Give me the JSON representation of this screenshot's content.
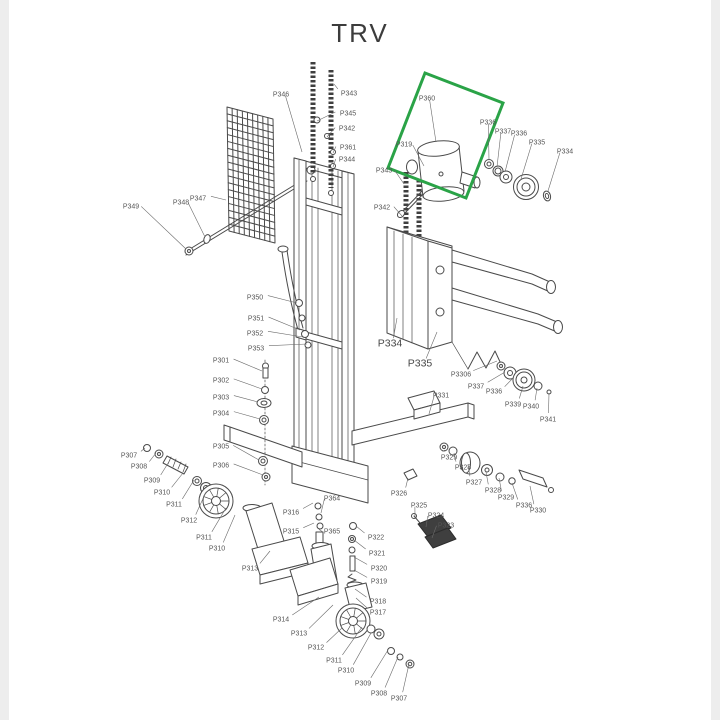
{
  "title": "TRV",
  "colors": {
    "line": "#4a4a4a",
    "label": "#555555",
    "highlight": "#2aa347",
    "background": "#ffffff"
  },
  "highlight_box": {
    "shape": "rotated-rectangle",
    "highlighted_part": "P360"
  },
  "labels": [
    {
      "t": "P343",
      "x": 349,
      "y": 93,
      "tx": 334,
      "ty": 84
    },
    {
      "t": "P345",
      "x": 348,
      "y": 113,
      "tx": 317,
      "ty": 121
    },
    {
      "t": "P342",
      "x": 347,
      "y": 128,
      "tx": 327,
      "ty": 137
    },
    {
      "t": "P361",
      "x": 348,
      "y": 147,
      "tx": 333,
      "ty": 153
    },
    {
      "t": "P344",
      "x": 347,
      "y": 159,
      "tx": 333,
      "ty": 167
    },
    {
      "t": "P346",
      "x": 281,
      "y": 94,
      "tx": 302,
      "ty": 152
    },
    {
      "t": "P347",
      "x": 198,
      "y": 198,
      "tx": 226,
      "ty": 200
    },
    {
      "t": "P348",
      "x": 181,
      "y": 202,
      "tx": 205,
      "ty": 237
    },
    {
      "t": "P349",
      "x": 131,
      "y": 206,
      "tx": 186,
      "ty": 249
    },
    {
      "t": "P343",
      "x": 384,
      "y": 170,
      "tx": 404,
      "ty": 184
    },
    {
      "t": "P342",
      "x": 382,
      "y": 207,
      "tx": 402,
      "ty": 216
    },
    {
      "t": "P360",
      "x": 427,
      "y": 98,
      "tx": 436,
      "ty": 142
    },
    {
      "t": "P319",
      "x": 404,
      "y": 144,
      "tx": 424,
      "ty": 166
    },
    {
      "t": "P336",
      "x": 488,
      "y": 122,
      "tx": 489,
      "ty": 160
    },
    {
      "t": "P337",
      "x": 503,
      "y": 131,
      "tx": 497,
      "ty": 167
    },
    {
      "t": "P336",
      "x": 519,
      "y": 133,
      "tx": 505,
      "ty": 172
    },
    {
      "t": "P335",
      "x": 537,
      "y": 142,
      "tx": 521,
      "ty": 179
    },
    {
      "t": "P334",
      "x": 565,
      "y": 151,
      "tx": 548,
      "ty": 191
    },
    {
      "t": "P334",
      "x": 390,
      "y": 344,
      "tx": 397,
      "ty": 318,
      "big": true
    },
    {
      "t": "P335",
      "x": 420,
      "y": 364,
      "tx": 437,
      "ty": 332,
      "big": true
    },
    {
      "t": "P3306",
      "x": 461,
      "y": 374,
      "tx": 497,
      "ty": 361
    },
    {
      "t": "P337",
      "x": 476,
      "y": 386,
      "tx": 505,
      "ty": 372
    },
    {
      "t": "P336",
      "x": 494,
      "y": 391,
      "tx": 514,
      "ty": 377
    },
    {
      "t": "P339",
      "x": 513,
      "y": 404,
      "tx": 523,
      "ty": 386
    },
    {
      "t": "P340",
      "x": 531,
      "y": 406,
      "tx": 537,
      "ty": 388
    },
    {
      "t": "P341",
      "x": 548,
      "y": 419,
      "tx": 549,
      "ty": 393
    },
    {
      "t": "P331",
      "x": 441,
      "y": 395,
      "tx": 429,
      "ty": 414
    },
    {
      "t": "P301",
      "x": 221,
      "y": 360,
      "tx": 262,
      "ty": 371
    },
    {
      "t": "P302",
      "x": 221,
      "y": 380,
      "tx": 262,
      "ty": 389
    },
    {
      "t": "P303",
      "x": 221,
      "y": 397,
      "tx": 258,
      "ty": 402
    },
    {
      "t": "P304",
      "x": 221,
      "y": 413,
      "tx": 260,
      "ty": 419
    },
    {
      "t": "P305",
      "x": 221,
      "y": 446,
      "tx": 259,
      "ty": 460
    },
    {
      "t": "P306",
      "x": 221,
      "y": 465,
      "tx": 263,
      "ty": 475
    },
    {
      "t": "P350",
      "x": 255,
      "y": 297,
      "tx": 297,
      "ty": 303
    },
    {
      "t": "P351",
      "x": 256,
      "y": 318,
      "tx": 300,
      "ty": 330
    },
    {
      "t": "P352",
      "x": 255,
      "y": 333,
      "tx": 303,
      "ty": 337
    },
    {
      "t": "P353",
      "x": 256,
      "y": 348,
      "tx": 307,
      "ty": 344
    },
    {
      "t": "P307",
      "x": 129,
      "y": 455,
      "tx": 145,
      "ty": 448
    },
    {
      "t": "P308",
      "x": 139,
      "y": 466,
      "tx": 156,
      "ty": 453
    },
    {
      "t": "P309",
      "x": 152,
      "y": 480,
      "tx": 170,
      "ty": 460
    },
    {
      "t": "P310",
      "x": 162,
      "y": 492,
      "tx": 183,
      "ty": 473
    },
    {
      "t": "P311",
      "x": 174,
      "y": 504,
      "tx": 194,
      "ty": 480
    },
    {
      "t": "P312",
      "x": 189,
      "y": 520,
      "tx": 206,
      "ty": 492
    },
    {
      "t": "P311",
      "x": 204,
      "y": 537,
      "tx": 226,
      "ty": 508
    },
    {
      "t": "P310",
      "x": 217,
      "y": 548,
      "tx": 235,
      "ty": 515
    },
    {
      "t": "P313",
      "x": 250,
      "y": 568,
      "tx": 270,
      "ty": 551
    },
    {
      "t": "P314",
      "x": 281,
      "y": 619,
      "tx": 319,
      "ty": 597
    },
    {
      "t": "P313",
      "x": 299,
      "y": 633,
      "tx": 333,
      "ty": 605
    },
    {
      "t": "P312",
      "x": 316,
      "y": 647,
      "tx": 342,
      "ty": 628
    },
    {
      "t": "P311",
      "x": 334,
      "y": 660,
      "tx": 362,
      "ty": 627
    },
    {
      "t": "P310",
      "x": 346,
      "y": 670,
      "tx": 371,
      "ty": 633
    },
    {
      "t": "P309",
      "x": 363,
      "y": 683,
      "tx": 388,
      "ty": 650
    },
    {
      "t": "P308",
      "x": 379,
      "y": 693,
      "tx": 398,
      "ty": 657
    },
    {
      "t": "P307",
      "x": 399,
      "y": 698,
      "tx": 409,
      "ty": 664
    },
    {
      "t": "P316",
      "x": 291,
      "y": 512,
      "tx": 313,
      "ty": 503
    },
    {
      "t": "P364",
      "x": 332,
      "y": 498,
      "tx": 321,
      "ty": 513
    },
    {
      "t": "P315",
      "x": 291,
      "y": 531,
      "tx": 314,
      "ty": 523
    },
    {
      "t": "P365",
      "x": 332,
      "y": 531,
      "tx": 323,
      "ty": 532
    },
    {
      "t": "P322",
      "x": 376,
      "y": 537,
      "tx": 356,
      "ty": 526
    },
    {
      "t": "P321",
      "x": 377,
      "y": 553,
      "tx": 354,
      "ty": 540
    },
    {
      "t": "P320",
      "x": 379,
      "y": 568,
      "tx": 354,
      "ty": 557
    },
    {
      "t": "P319",
      "x": 379,
      "y": 581,
      "tx": 354,
      "ty": 570
    },
    {
      "t": "P318",
      "x": 378,
      "y": 601,
      "tx": 355,
      "ty": 589
    },
    {
      "t": "P317",
      "x": 378,
      "y": 612,
      "tx": 356,
      "ty": 598
    },
    {
      "t": "P326",
      "x": 399,
      "y": 493,
      "tx": 408,
      "ty": 478
    },
    {
      "t": "P325",
      "x": 419,
      "y": 505,
      "tx": 415,
      "ty": 517
    },
    {
      "t": "P324",
      "x": 436,
      "y": 515,
      "tx": 426,
      "ty": 527
    },
    {
      "t": "P323",
      "x": 446,
      "y": 525,
      "tx": 432,
      "ty": 538
    },
    {
      "t": "P329",
      "x": 449,
      "y": 457,
      "tx": 445,
      "ty": 450
    },
    {
      "t": "P328",
      "x": 463,
      "y": 467,
      "tx": 454,
      "ty": 453
    },
    {
      "t": "P327",
      "x": 474,
      "y": 482,
      "tx": 468,
      "ty": 464
    },
    {
      "t": "P328",
      "x": 493,
      "y": 490,
      "tx": 486,
      "ty": 472
    },
    {
      "t": "P329",
      "x": 506,
      "y": 497,
      "tx": 499,
      "ty": 478
    },
    {
      "t": "P336",
      "x": 524,
      "y": 505,
      "tx": 512,
      "ty": 483
    },
    {
      "t": "P330",
      "x": 538,
      "y": 510,
      "tx": 530,
      "ty": 486
    }
  ]
}
